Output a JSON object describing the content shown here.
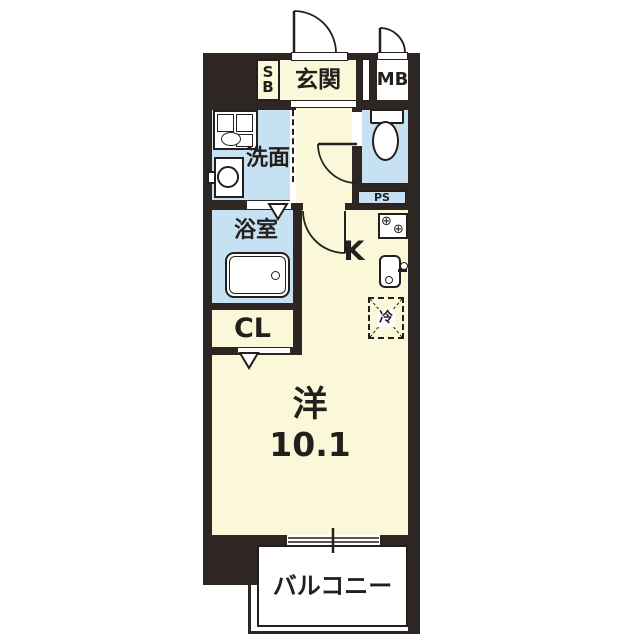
{
  "floorplan": {
    "labels": {
      "entrance": "玄関",
      "shoe_box_line1": "S",
      "shoe_box_line2": "B",
      "meter_box": "MB",
      "washroom": "洗面",
      "bathroom": "浴室",
      "pipe_space": "PS",
      "kitchen": "K",
      "closet": "CL",
      "western_room": "洋",
      "western_room_size": "10.1",
      "balcony": "バルコニー",
      "refrigerator": "冷"
    },
    "colors": {
      "wall": "#2e2623",
      "room_cream": "#fbf7d9",
      "room_blue": "#c6e1f2",
      "white": "#ffffff",
      "line": "#241f1d"
    }
  }
}
